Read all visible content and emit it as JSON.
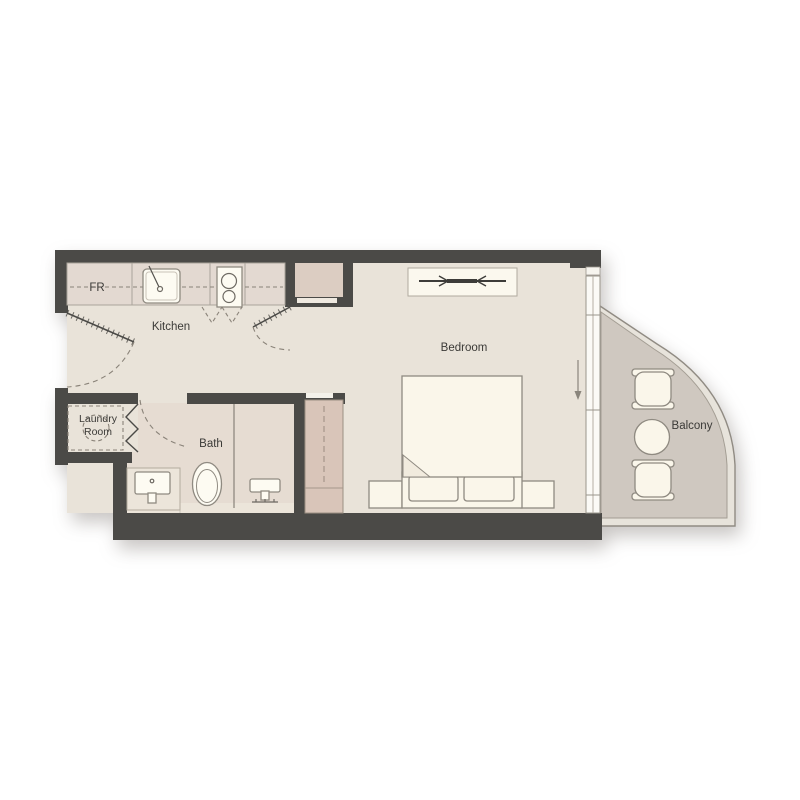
{
  "type": "floor-plan",
  "rooms": {
    "kitchen": {
      "label": "Kitchen"
    },
    "bedroom": {
      "label": "Bedroom"
    },
    "bath": {
      "label": "Bath"
    },
    "laundry_room": {
      "label": "Laundry Room",
      "label_line1": "Laundry",
      "label_line2": "Room"
    },
    "balcony": {
      "label": "Balcony"
    },
    "fridge": {
      "label": "FR"
    }
  },
  "fixtures": [
    "fridge",
    "kitchen-sink",
    "cooktop",
    "entry-door",
    "closet-door",
    "laundry-washer",
    "bifold-door",
    "bath-door",
    "vanity-sink",
    "toilet",
    "shower",
    "wardrobe",
    "bedroom-closet",
    "bed",
    "nightstands",
    "sliding-window",
    "balcony-chairs",
    "balcony-table"
  ],
  "colors": {
    "wall": "#4b4a47",
    "floor": "#e9e3d9",
    "floor_bath": "#e6dcd2",
    "counter": "#e3d9d1",
    "closet_pink": "#dccdc2",
    "wardrobe_pink": "#d9c5b9",
    "balcony_floor": "#cfc8c0",
    "balcony_rim": "#e7e3db",
    "furniture": "#faf6ea",
    "appliance": "#fdfbf2",
    "furniture_stroke": "#8f8a81",
    "line": "#aaa49a",
    "dash": "#8a8379",
    "text": "#3b3a37",
    "background": "#ffffff"
  }
}
